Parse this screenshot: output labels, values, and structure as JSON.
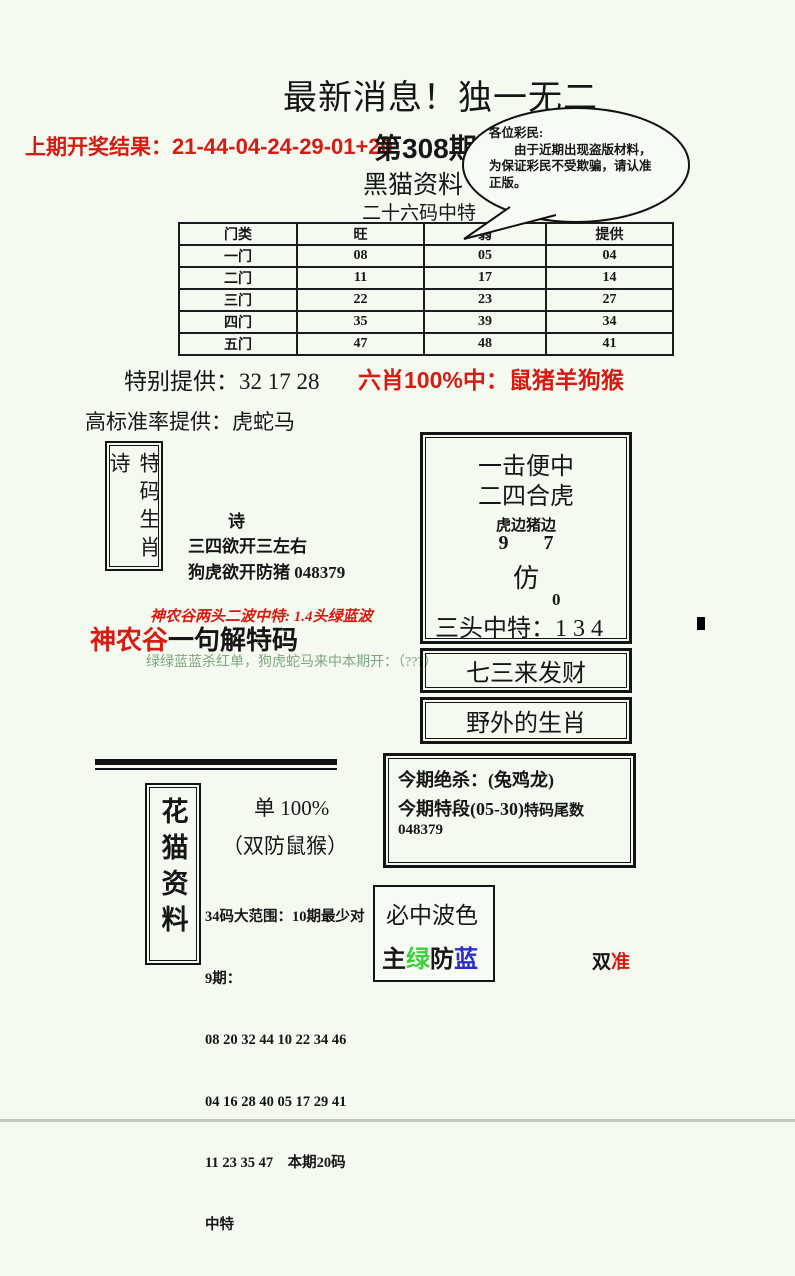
{
  "colors": {
    "background": "#f4faf0",
    "accent_red": "#d61b12",
    "muted_green_text": "#7fa57f",
    "bright_green": "#3ecf3e",
    "blue": "#2b2bd0",
    "black": "#161616"
  },
  "header": {
    "title": "最新消息！独一无二",
    "prev_label": "上期开奖结果：",
    "prev_numbers": "21-44-04-24-29-01+20",
    "issue": "第308期",
    "brand": "黑猫资料",
    "subtitle": "二十六码中特",
    "notice_line1": "各位彩民:",
    "notice_body": "由于近期出现盗版材料，为保证彩民不受欺骗，请认准正版。"
  },
  "gate_table": {
    "headers": [
      "门类",
      "旺",
      "弱",
      "提供"
    ],
    "rows": [
      [
        "一门",
        "08",
        "05",
        "04"
      ],
      [
        "二门",
        "11",
        "17",
        "14"
      ],
      [
        "三门",
        "22",
        "23",
        "27"
      ],
      [
        "四门",
        "35",
        "39",
        "34"
      ],
      [
        "五门",
        "47",
        "48",
        "41"
      ]
    ]
  },
  "special": {
    "label": "特别提供：",
    "numbers": "32 17 28"
  },
  "six_xiao": {
    "text": "六肖100%中：鼠猪羊狗猴"
  },
  "high_rate": {
    "text": "高标准率提供：虎蛇马"
  },
  "poem": {
    "box_title": "特码生肖诗",
    "heading": "诗",
    "line1": "三四欲开三左右",
    "line2": "狗虎欲开防猪 048379"
  },
  "shennonggu": {
    "top_line": "神农谷两头二波中特: 1.4头绿蓝波",
    "name": "神农谷",
    "title": "一句解特码",
    "green_line": "绿绿蓝蓝杀红单，狗虎蛇马来中本期开：（???）"
  },
  "strike_box": {
    "l1": "一击便中",
    "l2": "二四合虎",
    "l3": "虎边猪边",
    "l4": "9 7",
    "l5": "仿",
    "l6": "0",
    "l7": "三头中特：1 3 4"
  },
  "fortune_box": {
    "text": "七三来发财"
  },
  "wild_box": {
    "text": "野外的生肖"
  },
  "jinqi": {
    "line1": "今期绝杀：(兔鸡龙)",
    "line2a": "今期特段(05-30)",
    "line2b": "特码尾数 048379"
  },
  "huamao": {
    "box_title": "花猫资料",
    "dan": "单 100%",
    "shuangfang": "（双防鼠猴）",
    "lines": [
      "34码大范围：10期最少对",
      "9期：",
      "08 20 32 44 10 22 34 46",
      "04 16 28 40 05 17 29 41",
      "11 23 35 47    本期20码",
      "中特"
    ]
  },
  "wave": {
    "title": "必中波色",
    "c1": "主",
    "c2": "绿",
    "c3": "防",
    "c4": "蓝"
  },
  "seal": {
    "c1": "双",
    "c2": "准"
  }
}
